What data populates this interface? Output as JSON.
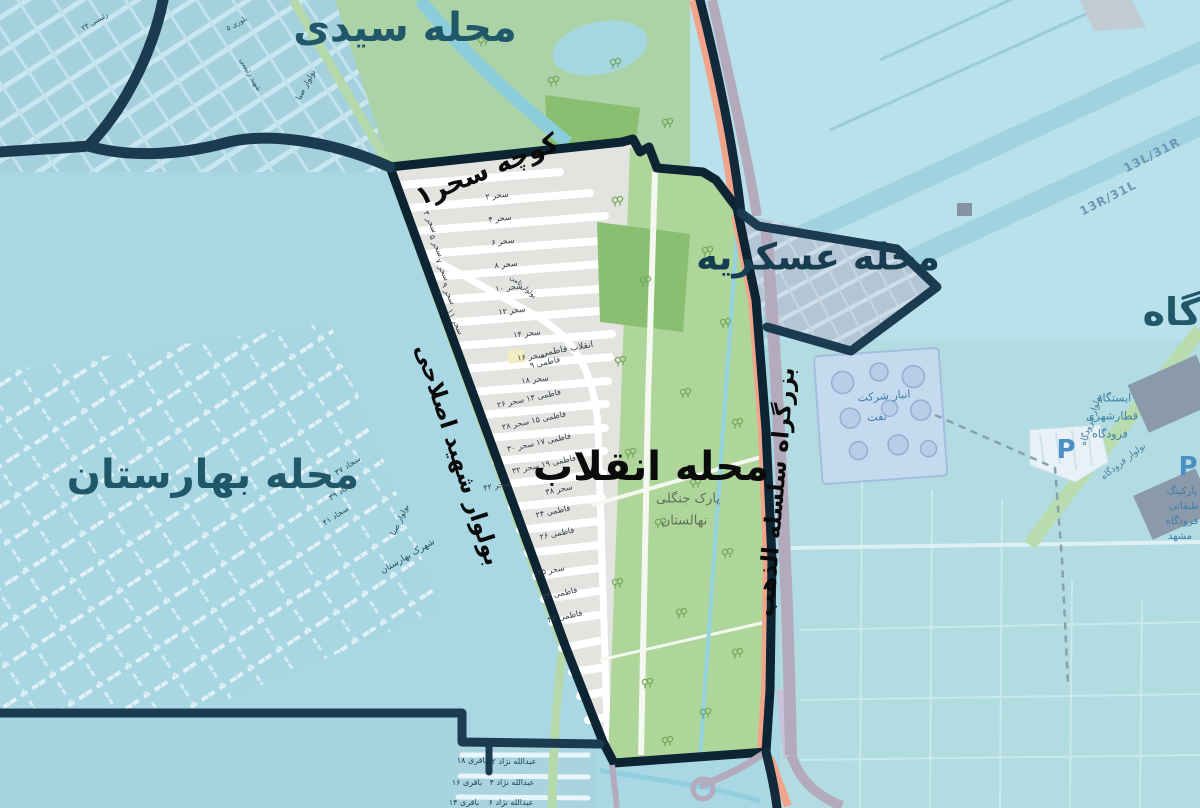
{
  "labels": {
    "neighborhoods": [
      {
        "text": "محله سیدی"
      },
      {
        "text": "محله عسکریه"
      },
      {
        "text": "محله انقلاب"
      },
      {
        "text": "محله بهارستان"
      },
      {
        "text": "گاه"
      }
    ],
    "roads": [
      "کوچه سحر۱",
      "بولوار شهید اصلاحی",
      "بزرگراه سلسله الذهب",
      "بولوار صبا",
      "بولوار ثامن",
      "بولوار فرودگاه"
    ],
    "park": [
      "پارک جنگلی",
      "نهالستان"
    ],
    "runways": [
      "13L/31R",
      "13R/31L"
    ],
    "enghelab_streets": [
      "سحر ۲",
      "سحر ۴",
      "سحر ۶",
      "سحر ۸",
      "سحر ۱۰",
      "سحر ۱۲",
      "سحر ۱۴",
      "سحر ۱۶",
      "سحر ۱۸",
      "سحر ۳",
      "سحر ۵",
      "سحر ۷",
      "سحر ۹",
      "سحر ۱۱",
      "انقلاب فاطمی",
      "فاطمی ۹",
      "فاطمی ۱۳ سحر ۲۶",
      "فاطمی ۱۵ سحر ۲۸",
      "فاطمی ۱۷ سحر ۳۰",
      "فاطمی ۱۹ سحر ۳۲",
      "سحر ۴۲",
      "سحر ۳۸",
      "فاطمی ۲۴",
      "فاطمی ۲۶",
      "سحر ۳۵",
      "فاطمی ۳۴",
      "فاطمی ۳۶"
    ],
    "baharestan_streets": [
      "شهرک بهارستان",
      "سجاد ۳۷",
      "سجاد ۳۹",
      "سجاد ۴۱"
    ],
    "topleft_streets": [
      "شهید رئیسی",
      "رئیسی ۲۴",
      "بلوری ۵"
    ],
    "bottom_streets": [
      "باقری ۱۸",
      "عبدالله نژاد ۲",
      "باقری ۱۶",
      "عبدالله نژاد ۴",
      "باقری ۱۴",
      "عبدالله نژاد ۶"
    ],
    "poi": {
      "depot_line1": "انبار شرکت",
      "depot_line2": "نفت",
      "station_line1": "ایستگاه",
      "station_line2": "قطارشهری",
      "station_line3": "فرودگاه",
      "parking_symbol": "P",
      "parking_line1": "پارکینگ",
      "parking_line2": "طبقاتی",
      "parking_line3": "فرودگاه",
      "parking_line4": "مشهد"
    }
  },
  "colors": {
    "water_base": "#a9d8e4",
    "boundary_navy": "#1b3c50",
    "enghelab_outline": "#0d2433",
    "built_gray": "#e3e3e0",
    "park_green": "#aed59a",
    "dark_green": "#8abf72",
    "highway_salmon": "#f1a48c",
    "boulevard_green": "#b5d9aa",
    "label_teal": "#20586a",
    "poi_blue": "#3d7fa8"
  }
}
